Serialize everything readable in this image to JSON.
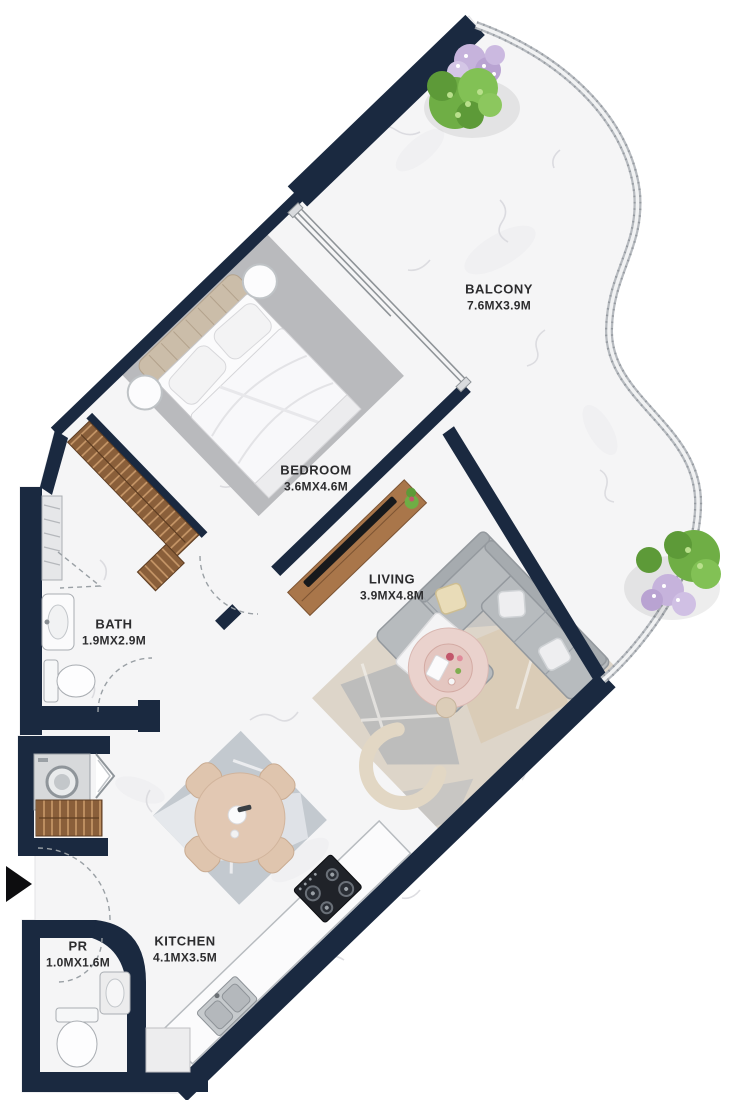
{
  "plan": {
    "type": "apartment-floor-plan",
    "rooms": [
      {
        "key": "balcony",
        "name": "BALCONY",
        "dims": "7.6MX3.9M"
      },
      {
        "key": "bedroom",
        "name": "BEDROOM",
        "dims": "3.6MX4.6M"
      },
      {
        "key": "living",
        "name": "LIVING",
        "dims": "3.9MX4.8M"
      },
      {
        "key": "bath",
        "name": "BATH",
        "dims": "1.9MX2.9M"
      },
      {
        "key": "kitchen",
        "name": "KITCHEN",
        "dims": "4.1MX3.5M"
      },
      {
        "key": "pr",
        "name": "PR",
        "dims": "1.0MX1.6M"
      }
    ],
    "entrance": {
      "marker": "arrow",
      "direction": "right"
    },
    "colors": {
      "wall": "#1a2940",
      "floor": "#f5f5f6",
      "wood": "#8a5f3a",
      "sofa": "#b7bbbe",
      "blush": "#e8cdc7",
      "greenery": "#6fae45",
      "lavender": "#c6b3dc",
      "label_text": "#2c2c2e"
    }
  }
}
